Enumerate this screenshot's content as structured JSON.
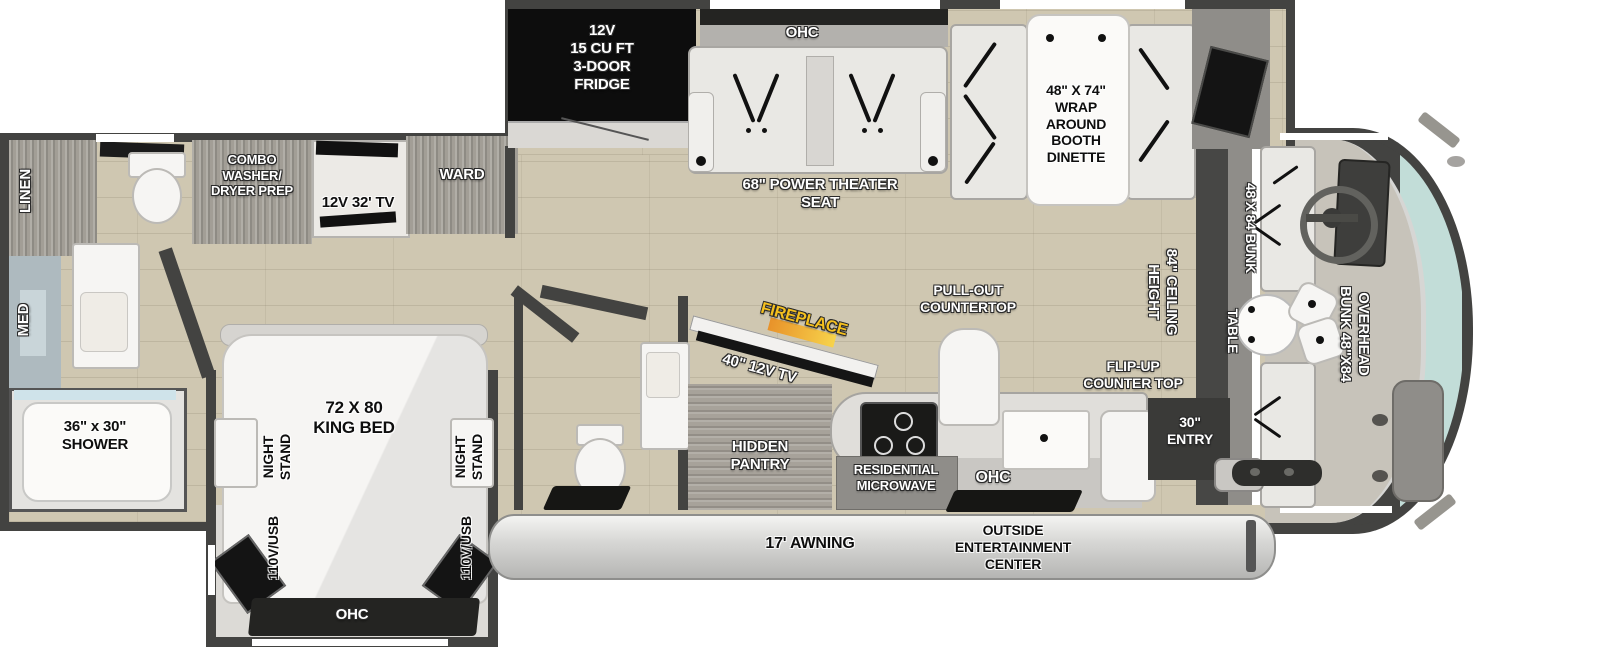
{
  "floorplan": {
    "top_slide": {
      "fridge": "12V\n15 CU FT\n3-DOOR\nFRIDGE",
      "ohc": "OHC",
      "theater_seat": "68\" POWER THEATER\nSEAT",
      "dinette": "48\" X 74\"\nWRAP\nAROUND\nBOOTH\nDINETTE"
    },
    "rear_bath": {
      "linen": "LINEN",
      "med": "MED",
      "shower": "36\" x 30\"\nSHOWER"
    },
    "bedroom": {
      "washer_dryer": "COMBO\nWASHER/\nDRYER PREP",
      "tv": "12V 32' TV",
      "wardrobe": "WARD",
      "bed": "72 X 80\nKING BED",
      "night_stand": "NIGHT\nSTAND",
      "outlet": "110V/USB",
      "ohc": "OHC"
    },
    "living": {
      "fireplace": "FIREPLACE",
      "tv": "40\" 12V TV",
      "pantry": "HIDDEN\nPANTRY",
      "pull_out_countertop": "PULL-OUT\nCOUNTERTOP",
      "flip_up_countertop": "FLIP-UP\nCOUNTER TOP",
      "entry": "30\"\nENTRY",
      "microwave": "RESIDENTIAL\nMICROWAVE",
      "ohc": "OHC",
      "ceiling_height": "84\" CEILING\nHEIGHT"
    },
    "front": {
      "bunk": "48 X 84 BUNK",
      "table": "TABLE",
      "overhead_bunk": "OVERHEAD\nBUNK 48\"X84"
    },
    "exterior": {
      "awning": "17' AWNING",
      "entertainment": "OUTSIDE\nENTERTAINMENT\nCENTER"
    },
    "colors": {
      "wall": "#434341",
      "floor": "#cfc7b1",
      "fireplace_accent": "#f5c01e",
      "windshield": "#c2ddd8",
      "awning_bar": "#d8d8d6"
    }
  }
}
